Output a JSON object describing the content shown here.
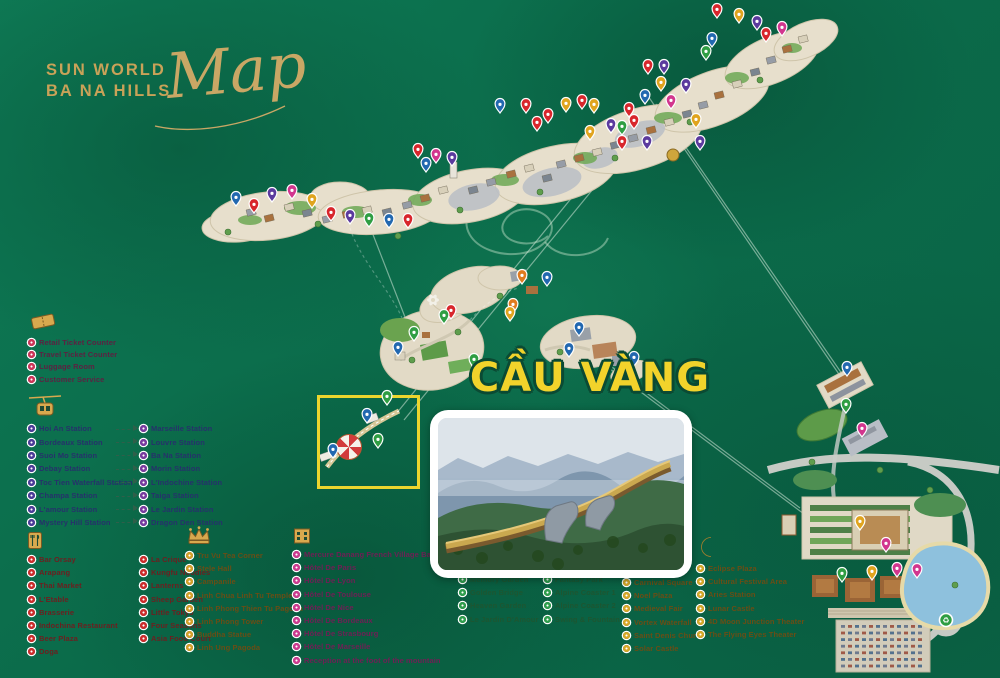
{
  "header": {
    "brand_line1": "SUN WORLD",
    "brand_line2": "BA NA HILLS",
    "script_title": "Map"
  },
  "colors": {
    "background": "#0b6b4a",
    "brand_gold": "#c9a258",
    "golden_label_yellow": "#f2d32b",
    "highlight_box_yellow": "#ecd52e",
    "pin": {
      "r": "#d8262c",
      "y": "#e0a41e",
      "p": "#5b3a9e",
      "b": "#2268b0",
      "g": "#2f9e43",
      "m": "#d2368e",
      "o": "#e07b1f",
      "re": "#2f9e43"
    }
  },
  "map": {
    "golden_bridge_label": "CẦU VÀNG",
    "pins": [
      [
        236,
        206,
        "b"
      ],
      [
        254,
        213,
        "r"
      ],
      [
        272,
        202,
        "p"
      ],
      [
        292,
        199,
        "m"
      ],
      [
        312,
        208,
        "y"
      ],
      [
        331,
        221,
        "r"
      ],
      [
        350,
        224,
        "p"
      ],
      [
        369,
        227,
        "g"
      ],
      [
        389,
        228,
        "b"
      ],
      [
        408,
        228,
        "r"
      ],
      [
        418,
        158,
        "r"
      ],
      [
        436,
        163,
        "m"
      ],
      [
        452,
        166,
        "p"
      ],
      [
        426,
        172,
        "b"
      ],
      [
        500,
        113,
        "b"
      ],
      [
        526,
        113,
        "r"
      ],
      [
        537,
        131,
        "r"
      ],
      [
        548,
        123,
        "r"
      ],
      [
        566,
        112,
        "y"
      ],
      [
        582,
        109,
        "r"
      ],
      [
        594,
        113,
        "y"
      ],
      [
        590,
        140,
        "y"
      ],
      [
        611,
        133,
        "p"
      ],
      [
        622,
        135,
        "g"
      ],
      [
        634,
        129,
        "r"
      ],
      [
        622,
        150,
        "r"
      ],
      [
        647,
        150,
        "p"
      ],
      [
        629,
        117,
        "r"
      ],
      [
        645,
        104,
        "b"
      ],
      [
        648,
        74,
        "r"
      ],
      [
        664,
        74,
        "p"
      ],
      [
        661,
        91,
        "y"
      ],
      [
        686,
        93,
        "p"
      ],
      [
        671,
        109,
        "m"
      ],
      [
        696,
        128,
        "y"
      ],
      [
        700,
        150,
        "p"
      ],
      [
        706,
        60,
        "g"
      ],
      [
        717,
        18,
        "r"
      ],
      [
        739,
        23,
        "y"
      ],
      [
        757,
        30,
        "p"
      ],
      [
        766,
        42,
        "r"
      ],
      [
        712,
        47,
        "b"
      ],
      [
        782,
        36,
        "m"
      ],
      [
        451,
        319,
        "r"
      ],
      [
        444,
        324,
        "g"
      ],
      [
        414,
        341,
        "g"
      ],
      [
        398,
        356,
        "b"
      ],
      [
        474,
        368,
        "g"
      ],
      [
        522,
        284,
        "o"
      ],
      [
        513,
        313,
        "o"
      ],
      [
        510,
        321,
        "y"
      ],
      [
        547,
        286,
        "b"
      ],
      [
        579,
        336,
        "b"
      ],
      [
        569,
        357,
        "b"
      ],
      [
        634,
        366,
        "b"
      ],
      [
        387,
        405,
        "g"
      ],
      [
        367,
        423,
        "b"
      ],
      [
        378,
        448,
        "g"
      ],
      [
        333,
        458,
        "b"
      ],
      [
        847,
        376,
        "b"
      ],
      [
        846,
        413,
        "g"
      ],
      [
        862,
        437,
        "m"
      ],
      [
        860,
        530,
        "y"
      ],
      [
        886,
        552,
        "m"
      ],
      [
        842,
        582,
        "g"
      ],
      [
        897,
        577,
        "m"
      ],
      [
        917,
        578,
        "m"
      ],
      [
        872,
        580,
        "y"
      ],
      [
        946,
        620,
        "re"
      ]
    ]
  },
  "legend": {
    "groups": [
      {
        "id": "tickets",
        "icon": "ticket-icon",
        "bullet": "#cf3358",
        "text": "#5c2242",
        "items": [
          "Retail Ticket Counter",
          "Travel Ticket Counter",
          "Luggage Room",
          "Customer Service"
        ]
      },
      {
        "id": "stations",
        "icon": "cable-car-icon",
        "bullet": "#4d3a99",
        "bullet2": "#7a3aa0",
        "text": "#26316b",
        "pairs": [
          [
            "Hoi An Station",
            "Marseille Station"
          ],
          [
            "Bordeaux Station",
            "Louvre Station"
          ],
          [
            "Suoi Mo Station",
            "Ba Na Station"
          ],
          [
            "Debay Station",
            "Morin Station"
          ],
          [
            "Toc Tien Waterfall Station",
            "L'Indochine Station"
          ],
          [
            "Champa Station",
            "Taiga Station"
          ],
          [
            "L'amour Station",
            "Le Jardin Station"
          ],
          [
            "Mystery Hill Station",
            "Dragon Den Station"
          ]
        ]
      },
      {
        "id": "dining",
        "icon": "dining-icon",
        "bullet": "#cf2b2b",
        "text": "#6b2020",
        "columns": [
          [
            "Bar Orsay",
            "Arapang",
            "Thai Market",
            "L'Etable",
            "Brasserie",
            "Indochina Restaurant",
            "Beer Plaza",
            "Doga"
          ],
          [
            "La Crique",
            "Kungfu Noodles",
            "Lanterns",
            "Sheep Garden",
            "Little Tokyo",
            "Four Seasons",
            "Asia Food Court"
          ]
        ]
      },
      {
        "id": "spiritual",
        "icon": "crown-icon",
        "bullet": "#d89f27",
        "text": "#6a4d15",
        "items": [
          "Tru Vu Tea Corner",
          "Stele Hall",
          "Campanile",
          "Linh Chua Linh Tu Temple",
          "Linh Phong Thien Tu Pagoda",
          "Linh Phong Tower",
          "Buddha Statue",
          "Linh Ung Pagoda"
        ]
      },
      {
        "id": "hotels",
        "icon": "hotel-icon",
        "bullet": "#cf3a90",
        "text": "#701f55",
        "items": [
          "Mercure Danang French Village Ba Na Hills Front Desk",
          "Hôtel De Paris",
          "Hôtel De Lyon",
          "Hôtel De Toulouse",
          "Hôtel De Nice",
          "Hôtel De Bordeaux",
          "Hôtel De Strasbourg",
          "Hôtel De Marseille",
          "Reception at the foot of the mountain"
        ]
      },
      {
        "id": "gardens",
        "icon": null,
        "bullet": "#2f9e4d",
        "text": "#1d5631",
        "columns": [
          [
            "Memory Garden",
            "Golden Bridge",
            "Heaven Garden",
            "Le Jardin D'Amour"
          ],
          [
            "Fantasy Park",
            "Alpine Coaster 1",
            "Alpine Coaster 2",
            "Swing & Fountain"
          ]
        ]
      },
      {
        "id": "squares",
        "icon": null,
        "bullet": "#d8a727",
        "text": "#6a4d15",
        "items": [
          "Carnival Square",
          "Noel Plaza",
          "Medieval Fair",
          "Vortex Waterfall",
          "Saint Denis Church",
          "Solar Castle"
        ]
      },
      {
        "id": "moonlight",
        "icon": "moon-icon",
        "bullet": "#d8a727",
        "text": "#6a4d15",
        "items": [
          "Eclipse Plaza",
          "Cultural Festival Area",
          "Aries Station",
          "Lunar Castle",
          "4D Moon Junction Theater",
          "The Flying Eyes Theater"
        ]
      }
    ]
  }
}
